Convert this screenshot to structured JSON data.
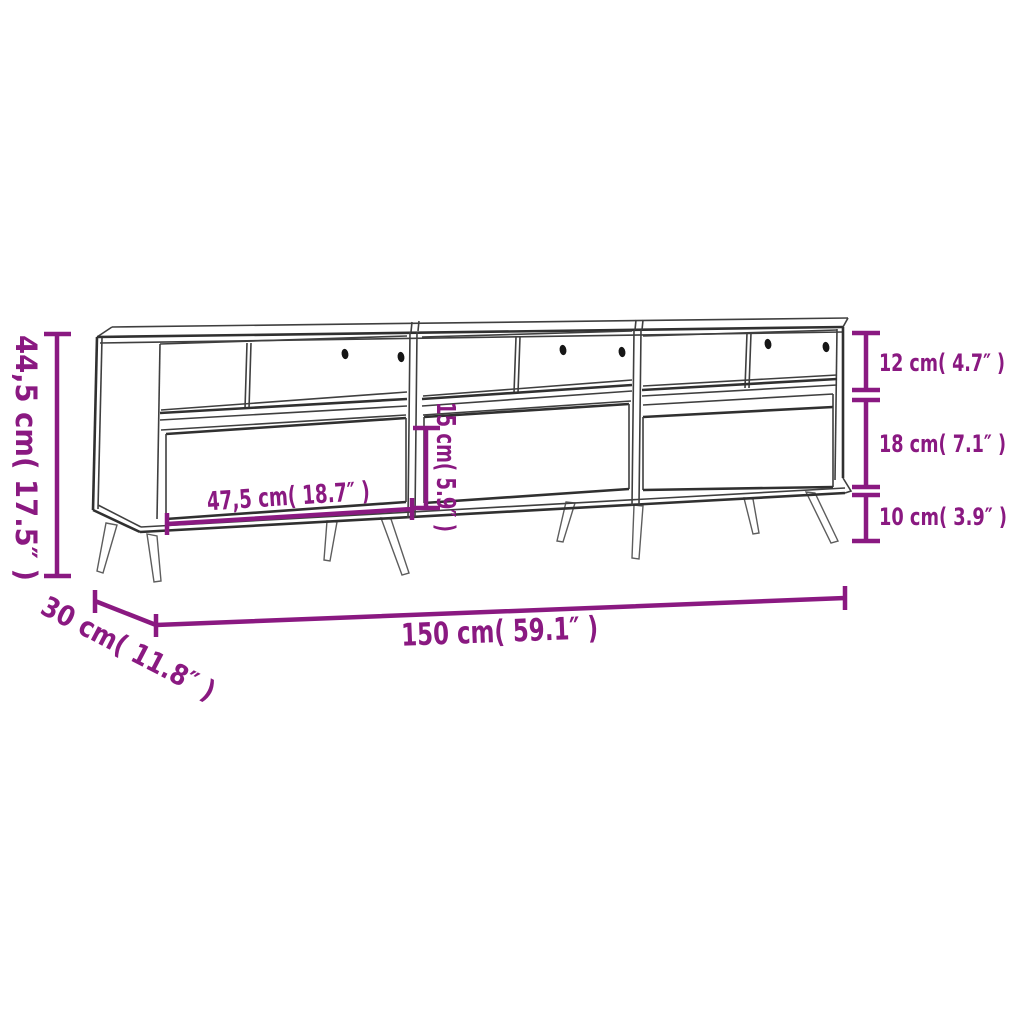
{
  "diagram": {
    "product": "tv-cabinet-with-drawers-dimension-drawing",
    "description": "Line drawing of a TV cabinet with 3 open compartments, 3 drawers and splayed metal legs, annotated with purple dimension lines",
    "units": [
      "cm",
      "inch"
    ],
    "colors": {
      "dimension_annotation": "#8a1981",
      "outline": "#3f3f3f",
      "background": "#ffffff"
    },
    "dimensions": {
      "overall_height": {
        "cm": "44,5",
        "in": "17.5",
        "label": "44,5 cm( 17.5″ )"
      },
      "overall_depth": {
        "cm": "30",
        "in": "11.8",
        "label": "30 cm( 11.8″ )"
      },
      "overall_width": {
        "cm": "150",
        "in": "59.1",
        "label": "150 cm( 59.1″ )"
      },
      "drawer_width": {
        "cm": "47,5",
        "in": "18.7",
        "label": "47,5 cm( 18.7″ )"
      },
      "middle_opening_height": {
        "cm": "15",
        "in": "5.9",
        "label": "15 cm( 5.9″ )"
      },
      "top_opening_height": {
        "cm": "12",
        "in": "4.7",
        "label": "12 cm( 4.7″ )"
      },
      "drawer_front_height": {
        "cm": "18",
        "in": "7.1",
        "label": "18 cm( 7.1″ )"
      },
      "leg_height": {
        "cm": "10",
        "in": "3.9",
        "label": "10 cm( 3.9″ )"
      }
    }
  }
}
